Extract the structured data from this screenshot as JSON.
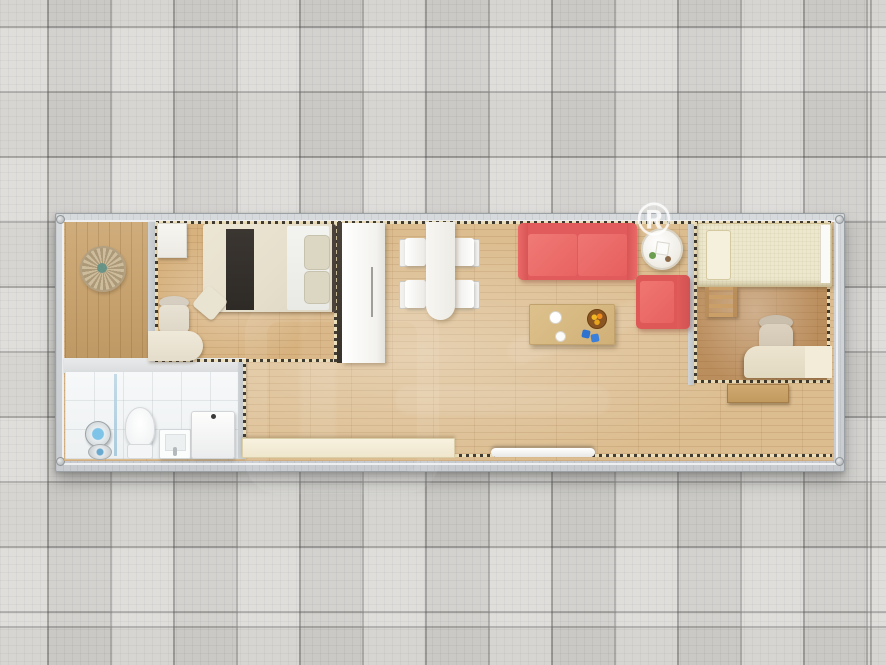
{
  "meta": {
    "description": "Top-down 3D rendering of a single-module container house floor plan on a gray tiled ground",
    "view": "top-down"
  },
  "watermark": {
    "registered_symbol": "®"
  },
  "palette": {
    "background_tile": "#d8d7d4",
    "tile_grout": "#8f8f8d",
    "frame_gray": "#cdd1d4",
    "frame_border": "#9aa0a4",
    "living_wood": "#dcbd90",
    "bedroom1_wood": "#d7b27f",
    "bedroom2_wood": "#bb8e5d",
    "porch_wood": "#c9a169",
    "bathroom_tile": "#f3f5f6",
    "sofa_red": "#e86261",
    "armchair_red": "#e25e5d",
    "bed_cream": "#e9e3d1",
    "bed2_cream": "#ece7cd",
    "dash_dark": "#39352c",
    "dash_light": "#ecdfbc",
    "glass_blue": "#9fc4da",
    "plant_green": "#6d9e4f",
    "fruit_orange": "#ef8c1f",
    "cup_blue": "#2f72cf"
  },
  "rooms": [
    {
      "name": "entry-porch",
      "furniture": [
        "round-wall-decor"
      ]
    },
    {
      "name": "bedroom-1",
      "furniture": [
        "wall-cabinet",
        "double-bed",
        "bed-runner",
        "pillows",
        "side-chair",
        "corner-desk",
        "sliding-rail",
        "wardrobe"
      ]
    },
    {
      "name": "bathroom",
      "furniture": [
        "shower-head",
        "floor-drain",
        "glass-partition",
        "toilet",
        "wash-basin",
        "water-heater"
      ]
    },
    {
      "name": "living-dining",
      "furniture": [
        "dining-table",
        "dining-chair-1",
        "dining-chair-2",
        "dining-chair-3",
        "dining-chair-4",
        "two-seat-sofa",
        "round-side-table",
        "armchair",
        "coffee-table",
        "fruit-bowl",
        "storage-bench",
        "door-threshold"
      ]
    },
    {
      "name": "bedroom-2",
      "furniture": [
        "loft-bed",
        "ladder",
        "office-chair",
        "work-desk",
        "nightstand"
      ]
    }
  ]
}
